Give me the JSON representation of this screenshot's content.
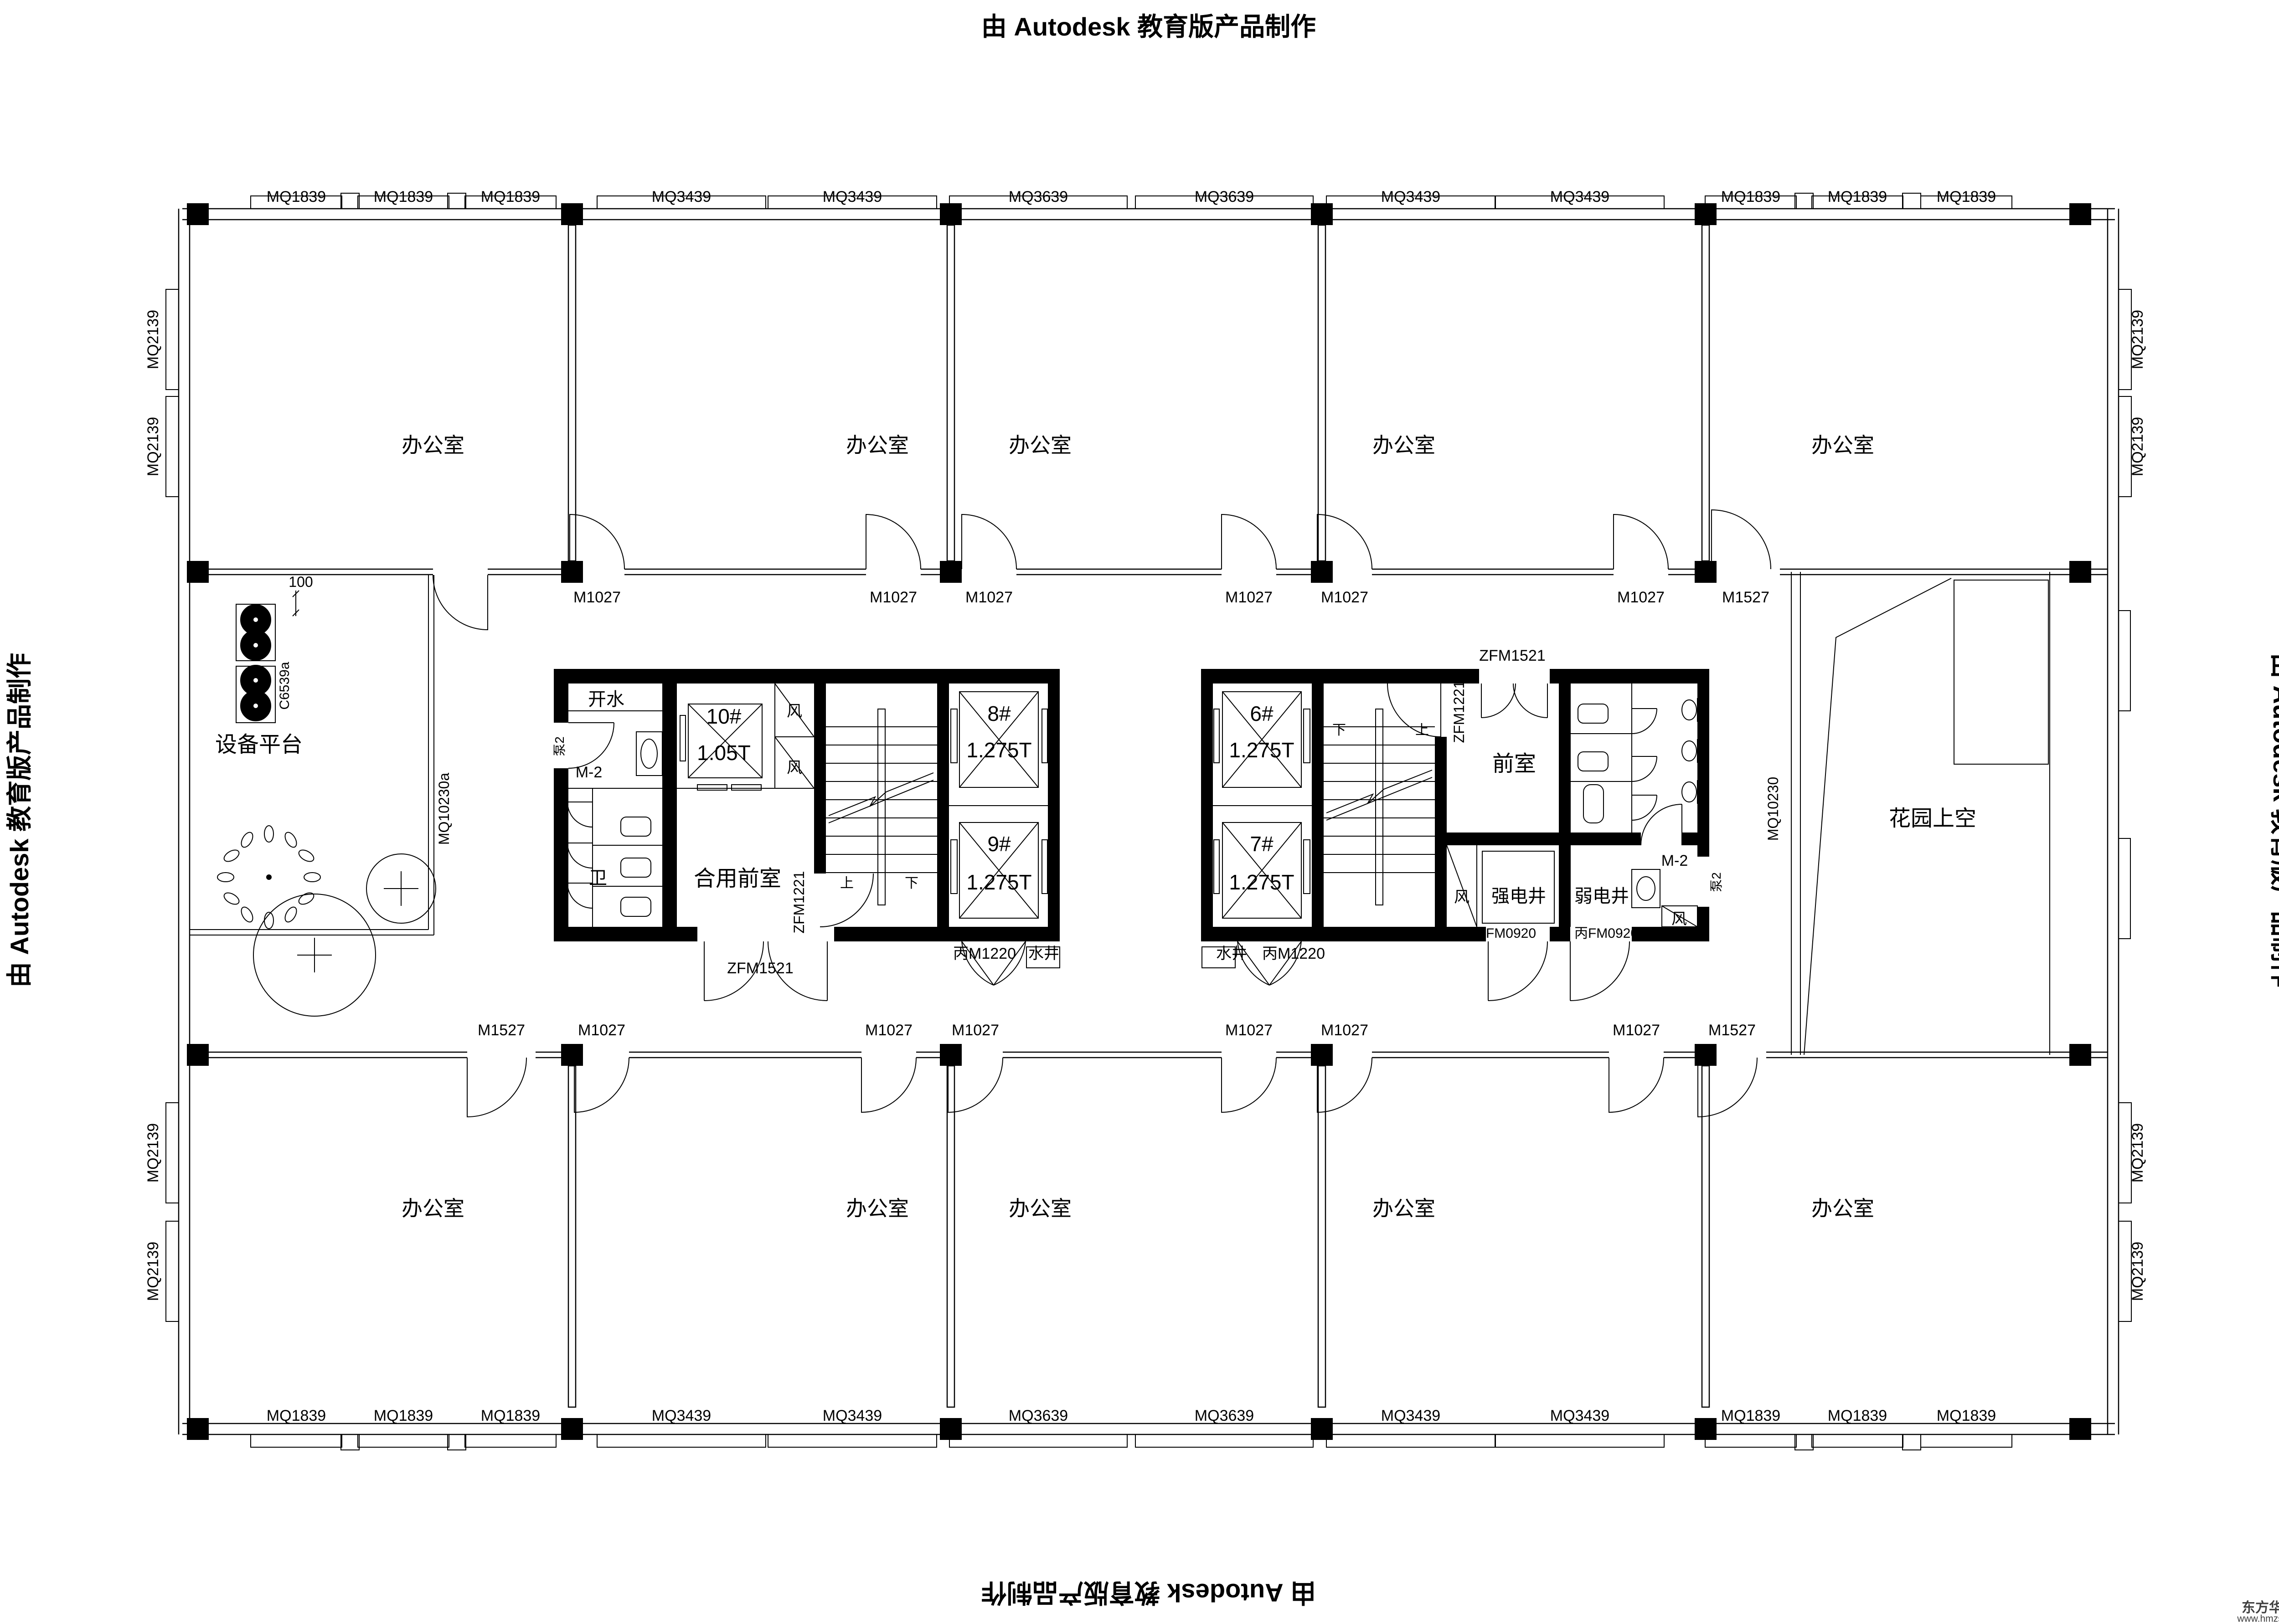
{
  "watermark": {
    "text": "由 Autodesk 教育版产品制作"
  },
  "logo": {
    "name": "东方华美",
    "site": "www.hmzs.net"
  },
  "windows": {
    "top": [
      "MQ1839",
      "MQ1839",
      "MQ1839",
      "MQ3439",
      "MQ3439",
      "MQ3639",
      "MQ3639",
      "MQ3439",
      "MQ3439",
      "MQ1839",
      "MQ1839",
      "MQ1839"
    ],
    "bottom": [
      "MQ1839",
      "MQ1839",
      "MQ1839",
      "MQ3439",
      "MQ3439",
      "MQ3639",
      "MQ3639",
      "MQ3439",
      "MQ3439",
      "MQ1839",
      "MQ1839",
      "MQ1839"
    ],
    "left": [
      "MQ2139",
      "MQ2139",
      "MQ2139",
      "MQ2139"
    ],
    "right": [
      "MQ2139",
      "MQ2139",
      "MQ2139",
      "MQ2139"
    ],
    "curtain_left": "MQ10230a",
    "curtain_right": "MQ10230"
  },
  "doors": {
    "top_row": [
      "M1027",
      "M1027",
      "M1027",
      "M1027",
      "M1027",
      "M1027",
      "M1527"
    ],
    "bottom_row": [
      "M1527",
      "M1027",
      "M1027",
      "M1027",
      "M1027",
      "M1027",
      "M1027",
      "M1527"
    ],
    "zfm1521": "ZFM1521",
    "zfm1221": "ZFM1221",
    "bm1220": "丙M1220",
    "bfm0920": "丙FM0920",
    "m2": "M-2",
    "pump2": "泵2"
  },
  "rooms": {
    "office": "办公室",
    "equipment_platform": "设备平台",
    "garden_void": "花园上空",
    "shared_front_room": "合用前室",
    "front_room": "前室",
    "toilet": "卫",
    "hot_water": "开水",
    "wind_shaft": "风",
    "water_shaft": "水井",
    "strong_elec_shaft": "强电井",
    "weak_elec_shaft": "弱电井"
  },
  "elevators": {
    "e10": {
      "no": "10#",
      "load": "1.05T"
    },
    "e8": {
      "no": "8#",
      "load": "1.275T"
    },
    "e9": {
      "no": "9#",
      "load": "1.275T"
    },
    "e6": {
      "no": "6#",
      "load": "1.275T"
    },
    "e7": {
      "no": "7#",
      "load": "1.275T"
    }
  },
  "annot": {
    "dim100": "100",
    "c6539a": "C6539a",
    "up": "上",
    "down": "下"
  }
}
